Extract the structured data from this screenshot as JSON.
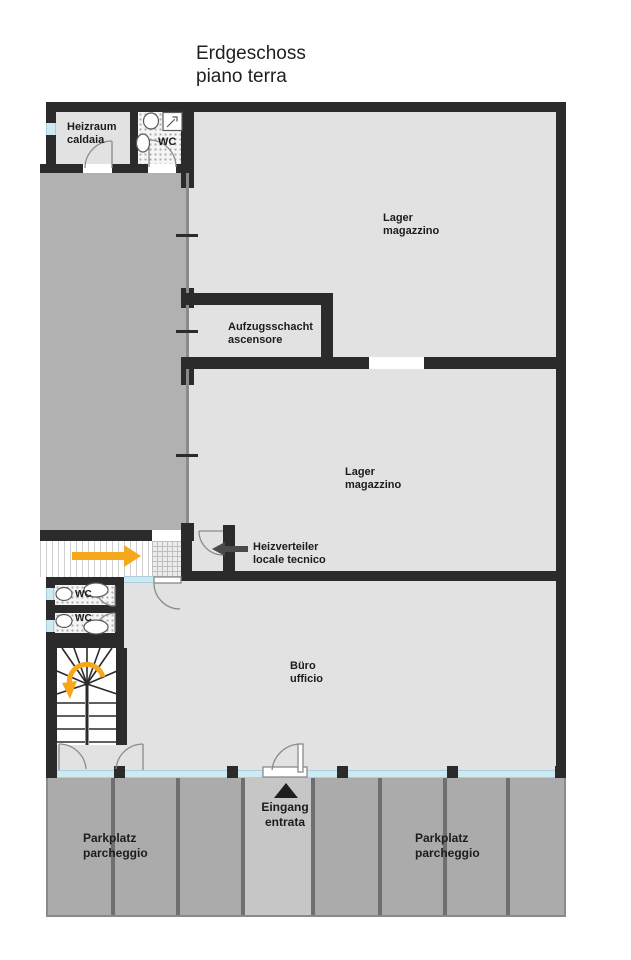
{
  "title": {
    "line1": "Erdgeschoss",
    "line2": "piano terra"
  },
  "labels": {
    "heizraum": {
      "line1": "Heizraum",
      "line2": "caldaia"
    },
    "wc_top": {
      "label": "WC"
    },
    "lager_upper": {
      "line1": "Lager",
      "line2": "magazzino"
    },
    "aufzugsschacht": {
      "line1": "Aufzugsschacht",
      "line2": "ascensore"
    },
    "lager_lower": {
      "line1": "Lager",
      "line2": "magazzino"
    },
    "heizverteiler": {
      "line1": "Heizverteiler",
      "line2": "locale tecnico"
    },
    "buero": {
      "line1": "Büro",
      "line2": "ufficio"
    },
    "wc_mid_upper": {
      "label": "WC"
    },
    "wc_mid_lower": {
      "label": "WC"
    },
    "eingang": {
      "line1": "Eingang",
      "line2": "entrata"
    },
    "parkplatz_left": {
      "line1": "Parkplatz",
      "line2": "parcheggio"
    },
    "parkplatz_right": {
      "line1": "Parkplatz",
      "line2": "parcheggio"
    }
  },
  "colors": {
    "wall": "#2b2b2b",
    "floor_interior": "#e2e2e2",
    "floor_driveway": "#b1b1b1",
    "floor_parking": "#ababab",
    "floor_walkway": "#c6c6c6",
    "parking_divider": "#6f6f6f",
    "glazing": "#cde9f2",
    "accent_orange": "#f5a81c",
    "arrow_dark": "#4a4a4a"
  }
}
